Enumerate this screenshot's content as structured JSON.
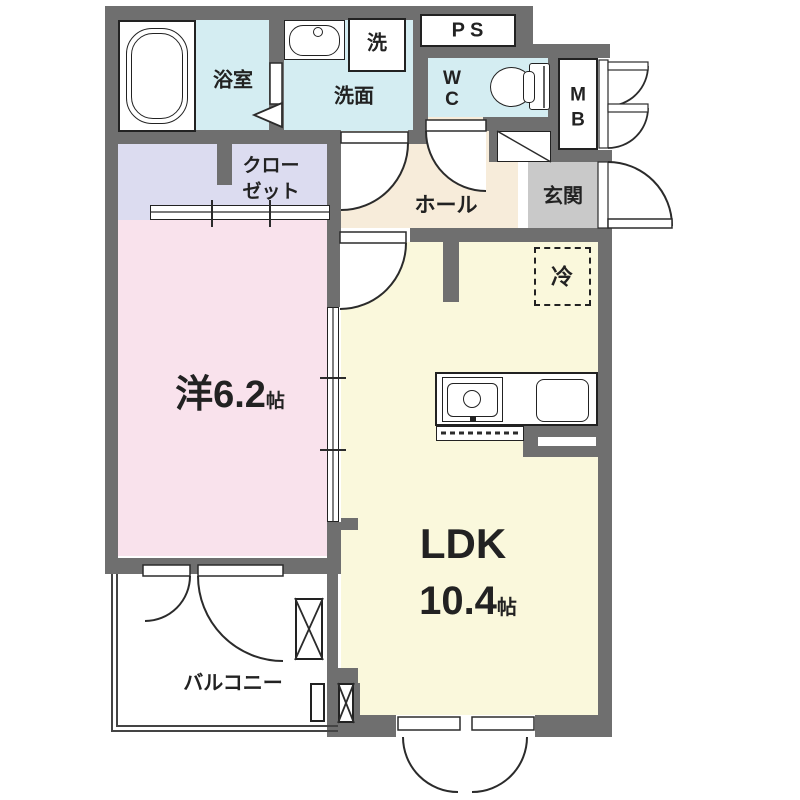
{
  "title": "1LDK apartment floor plan",
  "colors": {
    "wall": "#6f6f6f",
    "water": "#d4edf2",
    "closet": "#dcdcf0",
    "bedroom": "#f9e2ec",
    "hall": "#f7ecda",
    "entrance": "#c9c9c9",
    "ldk": "#faf8dc",
    "line": "#2b2b2b",
    "text": "#222222"
  },
  "rooms": {
    "bathroom": {
      "label": "浴室"
    },
    "washroom": {
      "label": "洗面"
    },
    "laundry": {
      "label": "洗"
    },
    "pipe_space": {
      "label": "PS"
    },
    "wc": {
      "line1": "W",
      "line2": "C"
    },
    "meter_box": {
      "line1": "M",
      "line2": "B"
    },
    "entrance": {
      "label": "玄関"
    },
    "hall": {
      "label": "ホール"
    },
    "closet": {
      "line1": "クロー",
      "line2": "ゼット"
    },
    "western_room": {
      "label": "洋6.2",
      "unit": "帖"
    },
    "ldk": {
      "label": "LDK",
      "size": "10.4",
      "unit": "帖"
    },
    "refrigerator": {
      "label": "冷"
    },
    "balcony": {
      "label": "バルコニー"
    }
  }
}
